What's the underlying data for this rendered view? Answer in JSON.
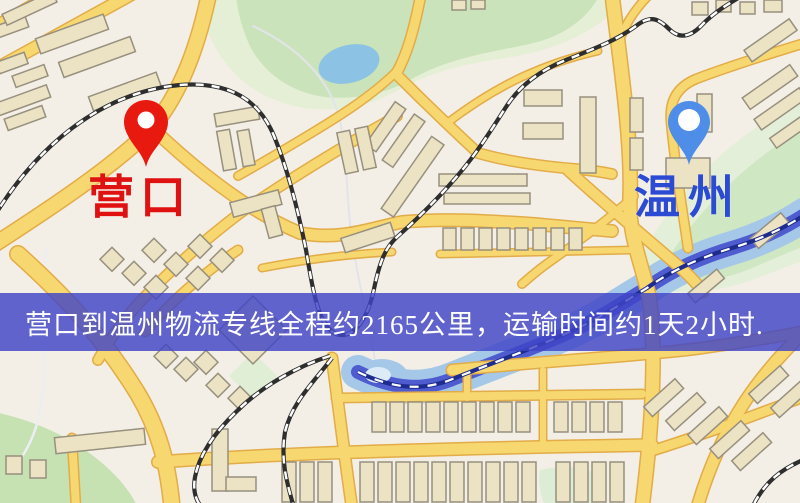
{
  "map": {
    "origin": {
      "label": "营口",
      "pin_color": "#e8190e",
      "label_color": "#e01111"
    },
    "destination": {
      "label": "温州",
      "pin_color": "#4e8ee8",
      "label_color": "#2b4bd3"
    },
    "banner": {
      "text": "营口到温州物流专线全程约2165公里，运输时间约1天2小时.",
      "background_color": "#4044c6",
      "text_color": "#ffffff"
    },
    "map_colors": {
      "background": "#f4efe6",
      "road_fill": "#f7d76f",
      "road_casing": "#e2ac48",
      "park_green": "#cbe3ba",
      "water_blue": "#8cc2e4",
      "river_core": "#4f5cd0",
      "railway_dark": "#2e2e2e",
      "railway_navy": "#1e2c8e",
      "building_fill": "#ece2c4"
    }
  }
}
